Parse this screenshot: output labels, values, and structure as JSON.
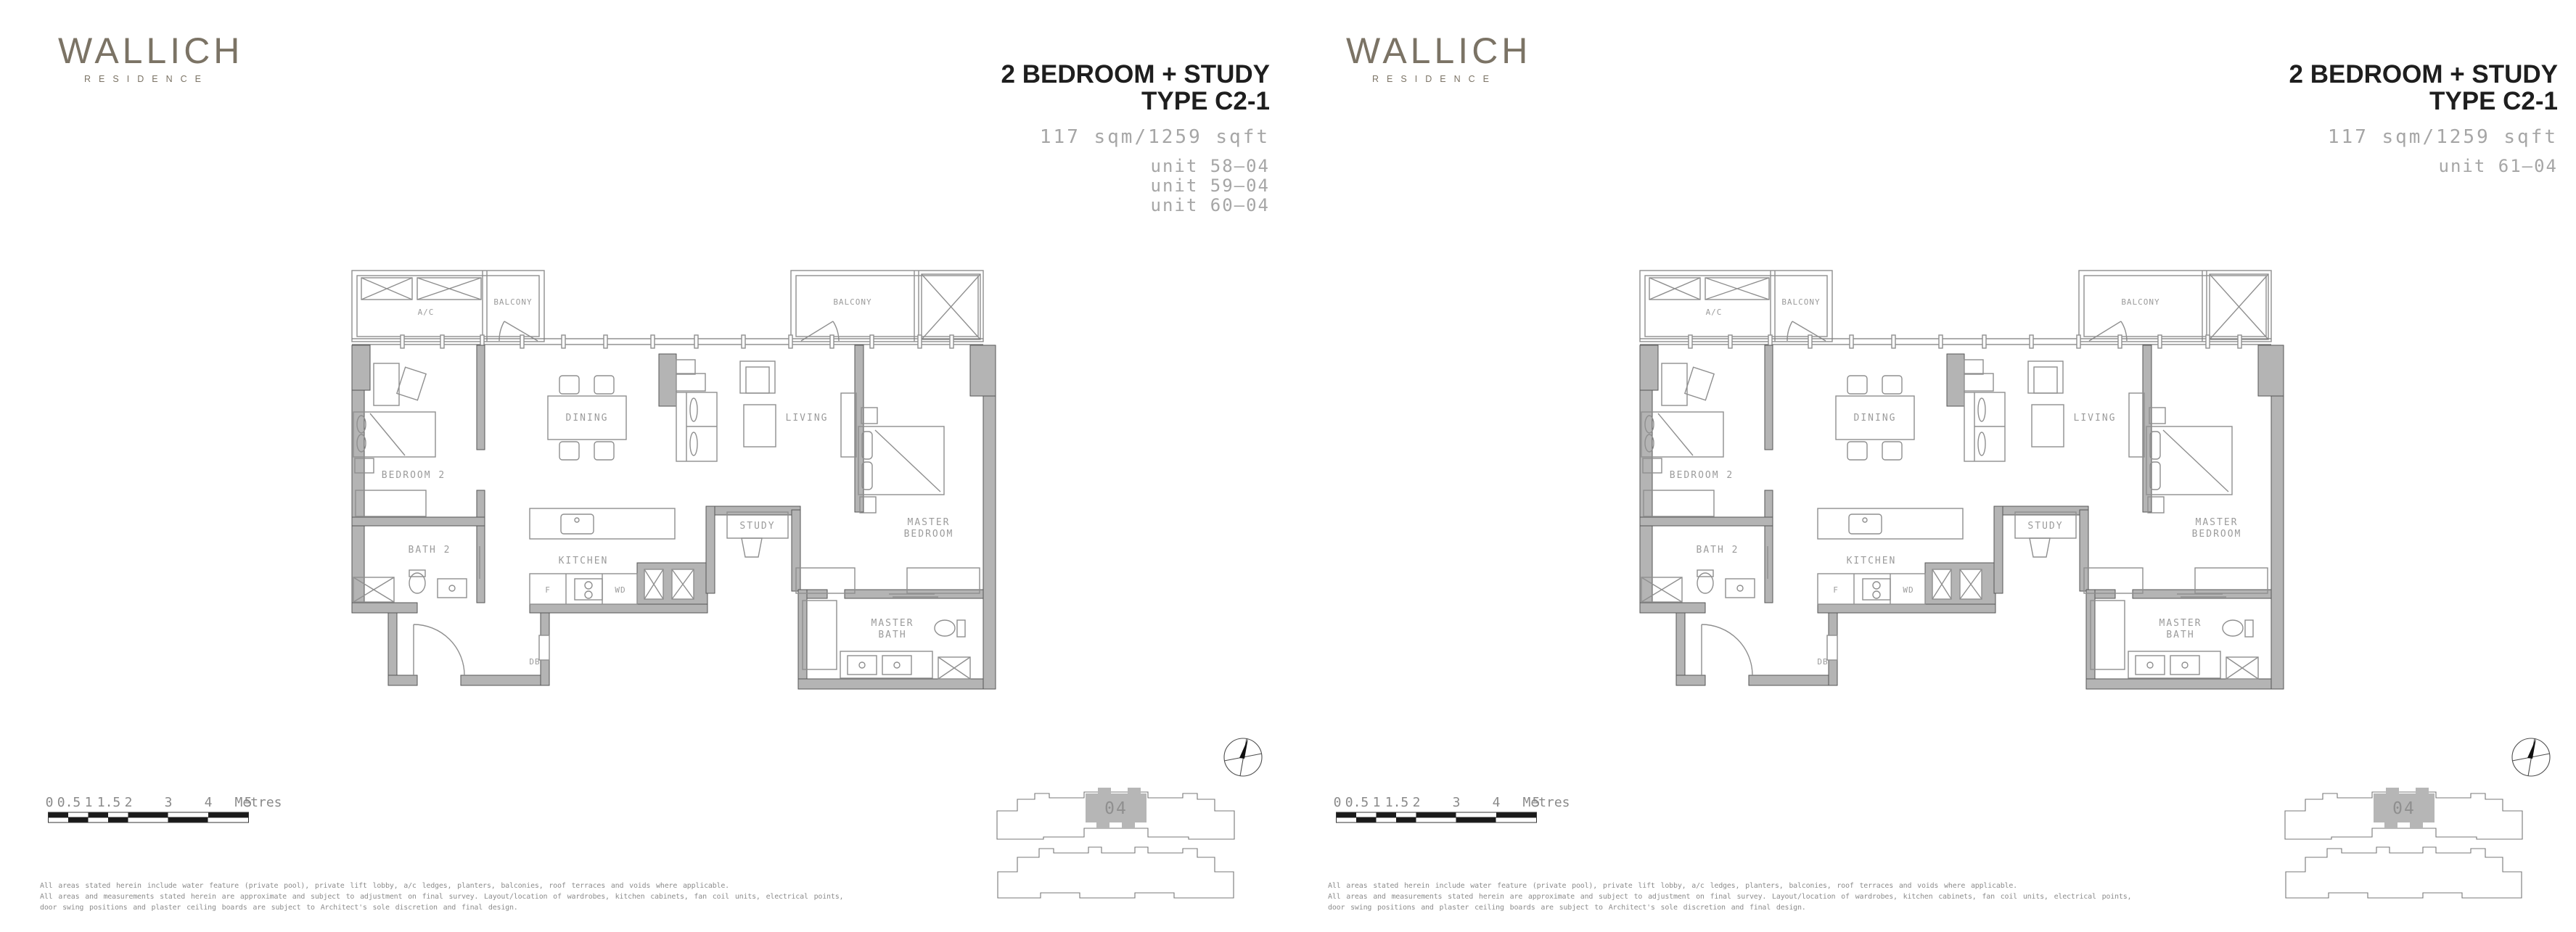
{
  "brand": {
    "name": "WALLICH",
    "sub": "RESIDENCE"
  },
  "shared": {
    "plan_labels": {
      "ac": "A/C",
      "balcony": "BALCONY",
      "bedroom2": "BEDROOM 2",
      "dining": "DINING",
      "living": "LIVING",
      "study": "STUDY",
      "kitchen": "KITCHEN",
      "bath2": "BATH 2",
      "master": "MASTER",
      "bedroom": "BEDROOM",
      "bath": "BATH",
      "f": "F",
      "wd": "WD",
      "db": "DB"
    },
    "scale": {
      "ticks": [
        "0",
        "0.5",
        "1",
        "1.5",
        "2",
        "3",
        "4",
        "5"
      ],
      "unit": "Metres"
    },
    "disclaimer": [
      "All areas stated herein include water feature (private pool), private lift lobby, a/c ledges, planters, balconies, roof terraces and voids where applicable.",
      "All areas and measurements stated herein are approximate and subject to adjustment on final survey. Layout/location of wardrobes, kitchen cabinets, fan coil units, electrical points,",
      "door swing positions and plaster ceiling boards are subject to Architect's sole discretion and final design."
    ],
    "keyplan_unit": "04"
  },
  "panels": [
    {
      "title_line1": "2 BEDROOM + STUDY",
      "title_line2": "TYPE C2-1",
      "area": "117 sqm/1259 sqft",
      "units": [
        "unit 58—04",
        "unit 59—04",
        "unit 60—04"
      ]
    },
    {
      "title_line1": "2 BEDROOM + STUDY",
      "title_line2": "TYPE C2-1",
      "area": "117 sqm/1259 sqft",
      "units": [
        "unit 61—04"
      ]
    }
  ]
}
